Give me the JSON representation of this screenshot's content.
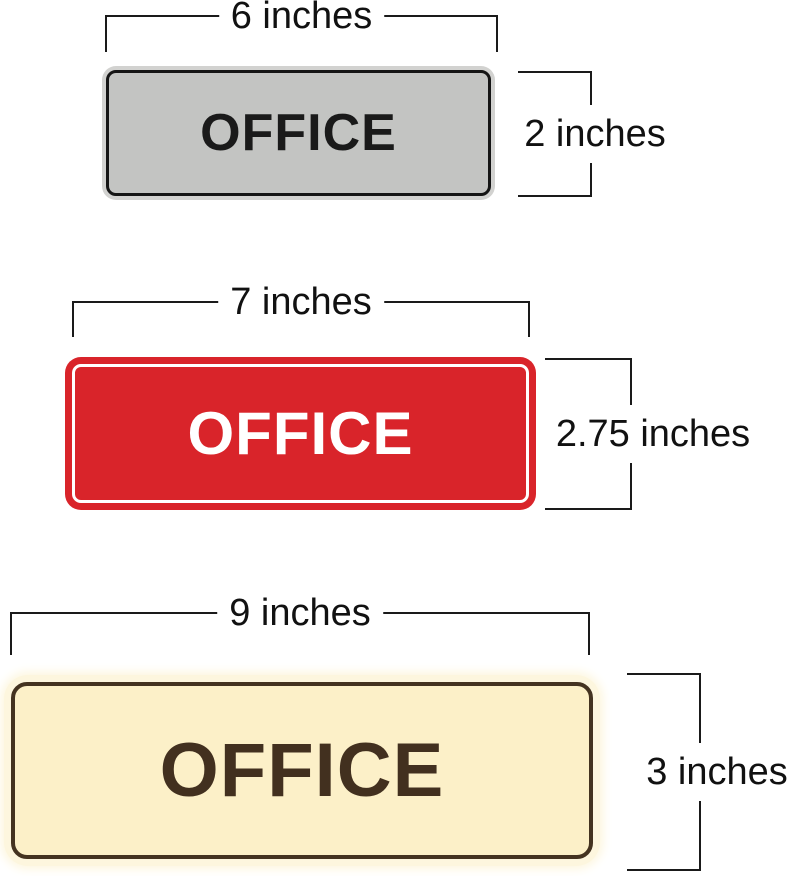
{
  "page": {
    "background": "#ffffff",
    "dimension_line_color": "#1a1a1a",
    "dimension_text_color": "#111111"
  },
  "signs": [
    {
      "id": "small",
      "label": "OFFICE",
      "width_label": "6 inches",
      "height_label": "2 inches",
      "colors": {
        "rim": "#D2D2D0",
        "fill": "#C3C4C2",
        "border": "#151515",
        "text": "#1A1A1A"
      }
    },
    {
      "id": "medium",
      "label": "OFFICE",
      "width_label": "7 inches",
      "height_label": "2.75 inches",
      "colors": {
        "rim": "#D9242A",
        "fill": "#D9242A",
        "border": "#FFFFFF",
        "text": "#FFFFFF"
      }
    },
    {
      "id": "large",
      "label": "OFFICE",
      "width_label": "9 inches",
      "height_label": "3 inches",
      "colors": {
        "rim": "#FDF6DE",
        "fill": "#FCF0C8",
        "border": "#443320",
        "text": "#42301F"
      }
    }
  ]
}
